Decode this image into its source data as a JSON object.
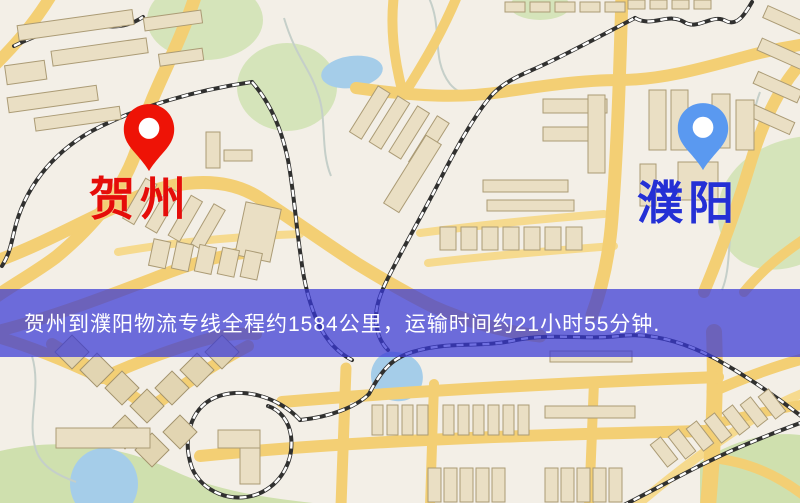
{
  "banner": {
    "text": "贺州到濮阳物流专线全程约1584公里，运输时间约21小时55分钟.",
    "background_color": "rgba(56,56,214,0.72)",
    "text_color": "#ffffff"
  },
  "origin": {
    "name": "贺州",
    "marker_color": "#ee1306",
    "label_color": "#e50d0a"
  },
  "destination": {
    "name": "濮阳",
    "marker_color": "#5a99f0",
    "label_color": "#2430d5"
  },
  "route": {
    "distance": "约1584公里",
    "duration": "约21小时55分钟"
  },
  "map_colors": {
    "background": "#f3efe7",
    "road": "#f3cf74",
    "railway": "#30302f",
    "building": "#eadfc4",
    "green_area": "#d5e4ba",
    "water": "#a5cde9"
  }
}
